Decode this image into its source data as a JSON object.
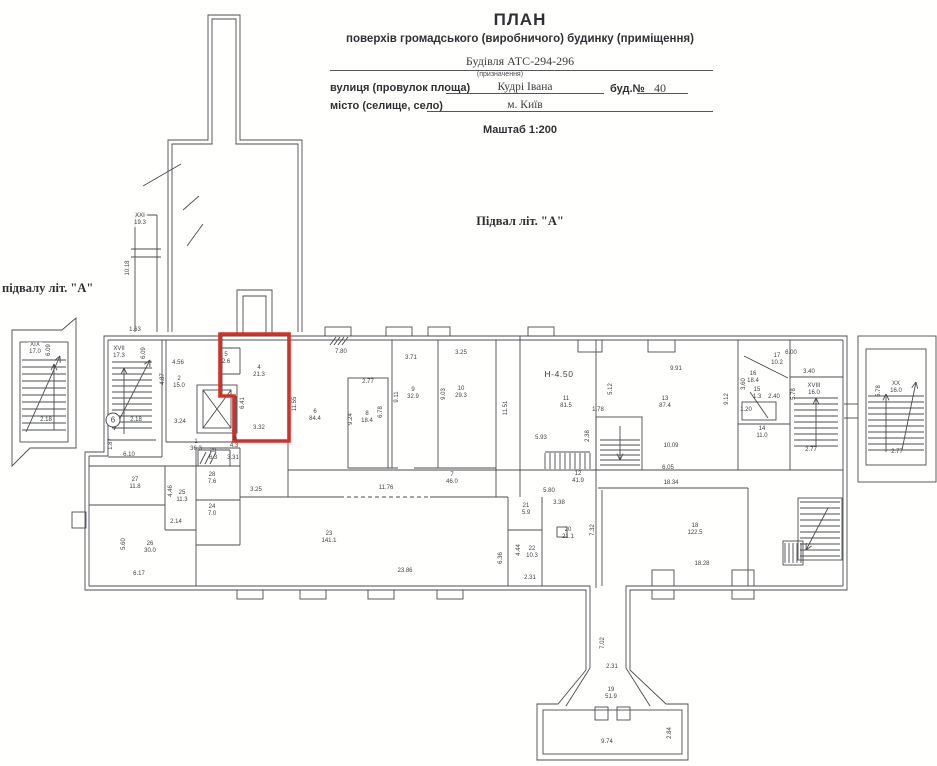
{
  "header": {
    "title": "ПЛАН",
    "subtitle": "поверхів громадського (виробничого) будинку (приміщення)",
    "building_value": "Будівля  АТС-294-296",
    "purpose_note": "(призначення)",
    "street_label": "вулиця (провулок площа)",
    "street_value": "Кудрі Івана",
    "house_label": "буд.№",
    "house_value": "40",
    "city_label": "місто (селище, село)",
    "city_value": "м. Київ",
    "scale": "Маштаб 1:200"
  },
  "captions": {
    "plan_title": "Підвал  літ. \"А\"",
    "left_caption": "підвалу  літ. \"А\""
  },
  "colors": {
    "line": "#4b4c50",
    "red": "#d43026",
    "tint": "#cfdde9",
    "label": "#3e3f43"
  },
  "plan": {
    "rooms": [
      [
        "1",
        "36.3",
        196,
        446
      ],
      [
        "2",
        "15.0",
        179,
        383
      ],
      [
        "3",
        "4.3",
        234,
        443
      ],
      [
        "4",
        "21.3",
        259,
        372
      ],
      [
        "5",
        "2.6",
        226,
        359
      ],
      [
        "6",
        "84.4",
        315,
        416
      ],
      [
        "7",
        "46.0",
        452,
        479
      ],
      [
        "8",
        "18.4",
        367,
        418
      ],
      [
        "9",
        "32.9",
        413,
        394
      ],
      [
        "10",
        "29.3",
        461,
        393
      ],
      [
        "11",
        "81.5",
        566,
        403
      ],
      [
        "12",
        "41.9",
        578,
        478
      ],
      [
        "13",
        "87.4",
        665,
        403
      ],
      [
        "14",
        "11.0",
        762,
        433
      ],
      [
        "15",
        "1.3",
        757,
        394
      ],
      [
        "16",
        "18.4",
        753,
        378
      ],
      [
        "17",
        "10.2",
        777,
        360
      ],
      [
        "18",
        "122.5",
        695,
        530
      ],
      [
        "19",
        "51.9",
        611,
        694
      ],
      [
        "20",
        "21.1",
        568,
        534
      ],
      [
        "21",
        "5.9",
        526,
        510
      ],
      [
        "22",
        "10.3",
        532,
        553
      ],
      [
        "23",
        "141.1",
        329,
        538
      ],
      [
        "24",
        "7.0",
        212,
        511
      ],
      [
        "25",
        "11.3",
        182,
        497
      ],
      [
        "26",
        "30.0",
        150,
        548
      ],
      [
        "27",
        "11.8",
        135,
        484
      ],
      [
        "28",
        "7.6",
        212,
        479
      ],
      [
        "29",
        "6.3",
        213,
        455
      ]
    ],
    "stairs": [
      [
        "XVII",
        "17.3",
        119,
        353
      ],
      [
        "XIX",
        "17.0",
        35,
        349
      ],
      [
        "XVIII",
        "16.0",
        814,
        390
      ],
      [
        "XX",
        "16.0",
        896,
        388
      ],
      [
        "XXI",
        "19.3",
        140,
        220
      ]
    ],
    "dims": [
      [
        "7.80",
        341,
        352,
        0
      ],
      [
        "11.55",
        295,
        404,
        1
      ],
      [
        "6.41",
        243,
        403,
        1
      ],
      [
        "3.32",
        259,
        428,
        0
      ],
      [
        "4.56",
        178,
        363,
        0
      ],
      [
        "4.87",
        163,
        379,
        1
      ],
      [
        "3.24",
        180,
        422,
        0
      ],
      [
        "3.31",
        233,
        458,
        0
      ],
      [
        "3.25",
        256,
        490,
        0
      ],
      [
        "2.77",
        368,
        382,
        0
      ],
      [
        "9.24",
        351,
        419,
        1
      ],
      [
        "6.78",
        381,
        412,
        1
      ],
      [
        "3.71",
        411,
        358,
        0
      ],
      [
        "9.11",
        397,
        397,
        1
      ],
      [
        "3.25",
        461,
        353,
        0
      ],
      [
        "9.03",
        444,
        394,
        1
      ],
      [
        "11.51",
        506,
        408,
        1
      ],
      [
        "5.93",
        541,
        438,
        0
      ],
      [
        "1.78",
        598,
        410,
        0
      ],
      [
        "2.38",
        588,
        436,
        1
      ],
      [
        "5.12",
        611,
        389,
        1
      ],
      [
        "9.91",
        676,
        369,
        0
      ],
      [
        "10.09",
        671,
        446,
        0
      ],
      [
        "9.12",
        727,
        399,
        1
      ],
      [
        "3.60",
        744,
        384,
        1
      ],
      [
        "2.40",
        774,
        397,
        0
      ],
      [
        "1.20",
        746,
        410,
        0
      ],
      [
        "6.00",
        791,
        353,
        0
      ],
      [
        "3.40",
        809,
        372,
        0
      ],
      [
        "5.78",
        794,
        394,
        1
      ],
      [
        "2.77",
        811,
        450,
        0
      ],
      [
        "6.10",
        129,
        455,
        0
      ],
      [
        "4.46",
        171,
        491,
        1
      ],
      [
        "2.14",
        176,
        522,
        0
      ],
      [
        "5.60",
        124,
        544,
        1
      ],
      [
        "6.17",
        139,
        574,
        0
      ],
      [
        "11.76",
        386,
        488,
        0
      ],
      [
        "23.86",
        405,
        571,
        0
      ],
      [
        "6.36",
        501,
        558,
        1
      ],
      [
        "5.80",
        549,
        491,
        0
      ],
      [
        "3.38",
        559,
        503,
        0
      ],
      [
        "4.44",
        519,
        550,
        1
      ],
      [
        "2.31",
        530,
        578,
        0
      ],
      [
        "7.32",
        593,
        530,
        1
      ],
      [
        "18.34",
        671,
        483,
        0
      ],
      [
        "18.28",
        702,
        564,
        0
      ],
      [
        "6.05",
        668,
        468,
        0
      ],
      [
        "7.02",
        603,
        643,
        1
      ],
      [
        "2.31",
        612,
        667,
        0
      ],
      [
        "9.74",
        607,
        742,
        0
      ],
      [
        "2.84",
        670,
        733,
        1
      ],
      [
        "1.63",
        135,
        330,
        0
      ],
      [
        "10.18",
        128,
        268,
        1
      ],
      [
        "1.87",
        111,
        444,
        1
      ],
      [
        "2.18",
        136,
        420,
        0
      ],
      [
        "6.09",
        144,
        353,
        1
      ],
      [
        "2.18",
        46,
        420,
        0
      ],
      [
        "6.09",
        49,
        350,
        1
      ],
      [
        "5.78",
        879,
        391,
        1
      ],
      [
        "2.77",
        897,
        452,
        0
      ]
    ],
    "height_mark": {
      "text": "Н-4.50",
      "x": 559,
      "y": 374
    },
    "node_mark": {
      "text": "6",
      "x": 113,
      "y": 420
    },
    "geometry": {
      "tints": [
        [
          520,
          328,
          325,
          272,
          0.5
        ],
        [
          845,
          330,
          92,
          160,
          0.45
        ],
        [
          520,
          600,
          270,
          166,
          0.5
        ],
        [
          556,
          0,
          34,
          148,
          0.3
        ]
      ],
      "paths": [
        "M104,336 L847,336 L847,590 L630,590 L630,670 L666,704 L688,704 L688,760 L537,760 L537,704 L558,704 L586,670 L586,590 L85,590 L85,452 L104,452 Z",
        "M168,332 L168,140 L208,140 L208,15 L240,15 L240,140 L302,140 L302,332",
        "M172,332 L172,144 L212,144 L212,19 L236,19 L236,144 L298,144 L298,332",
        "M237,336 L237,290 L272,290 L272,336",
        "M243,336 L243,296 L266,296 L266,336",
        "M12,330 L62,330 L76,318 L76,448 L30,448 L12,466 Z"
      ],
      "red": "M220,334 L289,334 L289,441 L234,441 L234,396 L220,396 Z",
      "rects": [
        [
          543,
          710,
          139,
          44
        ],
        [
          348,
          378,
          40,
          90
        ],
        [
          742,
          402,
          34,
          18
        ],
        [
          197,
          385,
          40,
          48
        ],
        [
          203,
          390,
          28,
          38
        ],
        [
          798,
          498,
          44,
          62
        ],
        [
          783,
          541,
          20,
          24
        ],
        [
          20,
          342,
          48,
          100
        ],
        [
          858,
          336,
          78,
          146
        ],
        [
          866,
          349,
          60,
          116
        ],
        [
          325,
          327,
          26,
          9
        ],
        [
          386,
          327,
          26,
          9
        ],
        [
          428,
          327,
          22,
          9
        ],
        [
          528,
          327,
          26,
          9
        ],
        [
          578,
          340,
          24,
          12
        ],
        [
          648,
          340,
          27,
          12
        ],
        [
          237,
          590,
          26,
          9
        ],
        [
          300,
          590,
          26,
          9
        ],
        [
          368,
          590,
          26,
          9
        ],
        [
          437,
          590,
          26,
          9
        ],
        [
          652,
          590,
          22,
          9
        ],
        [
          732,
          590,
          22,
          9
        ],
        [
          652,
          570,
          22,
          16
        ],
        [
          732,
          570,
          22,
          16
        ],
        [
          72,
          512,
          14,
          16
        ],
        [
          595,
          707,
          13,
          13
        ],
        [
          617,
          707,
          13,
          13
        ],
        [
          557,
          527,
          10,
          10
        ],
        [
          596,
          417,
          46,
          53
        ]
      ],
      "lines": [
        [
          108,
          340,
          843,
          340
        ],
        [
          843,
          340,
          843,
          586
        ],
        [
          843,
          586,
          626,
          586
        ],
        [
          590,
          586,
          89,
          586
        ],
        [
          89,
          586,
          89,
          456
        ],
        [
          89,
          456,
          108,
          456
        ],
        [
          108,
          456,
          108,
          340
        ],
        [
          590,
          586,
          590,
          668
        ],
        [
          626,
          586,
          626,
          668
        ],
        [
          590,
          668,
          566,
          706
        ],
        [
          626,
          668,
          650,
          706
        ],
        [
          135,
          215,
          157,
          215
        ],
        [
          135,
          215,
          135,
          332
        ],
        [
          157,
          215,
          157,
          332
        ],
        [
          131,
          249,
          161,
          249
        ],
        [
          131,
          257,
          161,
          257
        ],
        [
          143,
          186,
          181,
          164
        ],
        [
          183,
          210,
          199,
          196
        ],
        [
          187,
          246,
          203,
          224
        ],
        [
          162,
          340,
          162,
          457
        ],
        [
          108,
          457,
          162,
          457
        ],
        [
          166,
          340,
          166,
          442
        ],
        [
          222,
          336,
          222,
          396
        ],
        [
          222,
          396,
          236,
          396
        ],
        [
          236,
          396,
          236,
          442
        ],
        [
          166,
          442,
          288,
          442
        ],
        [
          222,
          348,
          240,
          348
        ],
        [
          240,
          348,
          240,
          374
        ],
        [
          222,
          374,
          240,
          374
        ],
        [
          288,
          340,
          288,
          497
        ],
        [
          392,
          340,
          392,
          468
        ],
        [
          438,
          340,
          438,
          468
        ],
        [
          496,
          340,
          496,
          497
        ],
        [
          520,
          336,
          520,
          497
        ],
        [
          348,
          468,
          398,
          468
        ],
        [
          414,
          468,
          496,
          468
        ],
        [
          288,
          470,
          520,
          470
        ],
        [
          520,
          470,
          790,
          470
        ],
        [
          596,
          340,
          596,
          588
        ],
        [
          545,
          452,
          590,
          452
        ],
        [
          738,
          340,
          738,
          470
        ],
        [
          744,
          356,
          788,
          378
        ],
        [
          738,
          424,
          790,
          424
        ],
        [
          750,
          392,
          768,
          418
        ],
        [
          790,
          340,
          790,
          470
        ],
        [
          790,
          377,
          843,
          377
        ],
        [
          790,
          470,
          843,
          470
        ],
        [
          598,
          488,
          748,
          488
        ],
        [
          602,
          490,
          602,
          586
        ],
        [
          748,
          488,
          748,
          586
        ],
        [
          508,
          497,
          508,
          586
        ],
        [
          542,
          497,
          542,
          586
        ],
        [
          508,
          530,
          542,
          530
        ],
        [
          240,
          497,
          340,
          497
        ],
        [
          430,
          497,
          508,
          497
        ],
        [
          89,
          466,
          240,
          466
        ],
        [
          165,
          466,
          165,
          530
        ],
        [
          196,
          448,
          196,
          586
        ],
        [
          240,
          448,
          240,
          545
        ],
        [
          196,
          448,
          240,
          448
        ],
        [
          89,
          505,
          165,
          505
        ],
        [
          165,
          530,
          196,
          530
        ],
        [
          196,
          500,
          240,
          500
        ],
        [
          196,
          545,
          240,
          545
        ],
        [
          198,
          450,
          230,
          450
        ],
        [
          198,
          450,
          198,
          466
        ],
        [
          230,
          450,
          230,
          466
        ],
        [
          200,
          464,
          206,
          452
        ],
        [
          205,
          464,
          211,
          452
        ],
        [
          210,
          464,
          216,
          452
        ],
        [
          203,
          390,
          231,
          428
        ],
        [
          231,
          390,
          203,
          428
        ],
        [
          232,
          430,
          238,
          442
        ],
        [
          330,
          345,
          336,
          337
        ],
        [
          334,
          345,
          340,
          337
        ],
        [
          338,
          345,
          344,
          337
        ],
        [
          342,
          345,
          348,
          337
        ],
        [
          844,
          404,
          858,
          404
        ],
        [
          844,
          418,
          858,
          418
        ],
        [
          108,
          440,
          156,
          440
        ]
      ],
      "dashed": [
        [
          340,
          497,
          430,
          497
        ]
      ],
      "stairsH": [
        [
          112,
          362,
          40,
          66,
          6
        ],
        [
          22,
          360,
          44,
          76,
          7
        ],
        [
          868,
          396,
          56,
          58,
          6
        ],
        [
          794,
          398,
          44,
          50,
          6
        ],
        [
          800,
          502,
          40,
          54,
          6
        ],
        [
          600,
          440,
          40,
          26,
          5
        ]
      ],
      "stairsV": [
        [
          545,
          453,
          45,
          16,
          5
        ],
        [
          785,
          543,
          16,
          20,
          4
        ]
      ],
      "arrows": [
        [
          124,
          434,
          124,
          368
        ],
        [
          114,
          430,
          150,
          360
        ],
        [
          26,
          432,
          60,
          356
        ],
        [
          54,
          430,
          54,
          364
        ],
        [
          886,
          452,
          886,
          394
        ],
        [
          902,
          450,
          916,
          382
        ],
        [
          816,
          446,
          816,
          398
        ],
        [
          828,
          508,
          806,
          550
        ],
        [
          620,
          426,
          620,
          460
        ]
      ]
    }
  }
}
